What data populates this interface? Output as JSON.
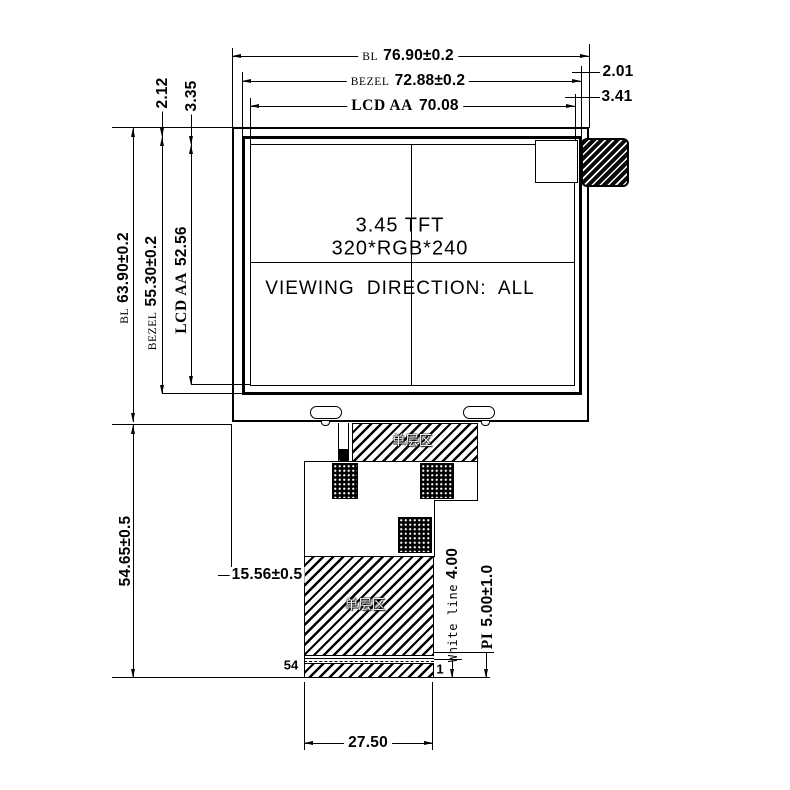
{
  "labels": {
    "top": [
      {
        "prefix": "BL",
        "value": "76.90±0.2"
      },
      {
        "prefix": "BEZEL",
        "value": "72.88±0.2"
      },
      {
        "prefix": "LCD AA",
        "value": "70.08"
      }
    ],
    "right": [
      "2.01",
      "3.41"
    ],
    "top_left": [
      "2.12",
      "3.35"
    ],
    "left": [
      {
        "prefix": "BL",
        "value": "63.90±0.2"
      },
      {
        "prefix": "BEZEL",
        "value": "55.30±0.2"
      },
      {
        "prefix": "LCD AA",
        "value": "52.56"
      }
    ],
    "total_height": "54.65±0.5",
    "fpc_offset": "15.56±0.5",
    "tail_width": "27.50",
    "pin_left": "54",
    "pin_right": "1",
    "white_line_prefix": "White line",
    "white_line_value": "4.00",
    "pi_prefix": "PI",
    "pi_value": "5.00±1.0",
    "single_layer": "单层区"
  },
  "panel": {
    "size_line": "3.45 TFT",
    "resolution_line": "320*RGB*240",
    "viewing_line": "VIEWING DIRECTION: ALL"
  },
  "colors": {
    "line": "#000000",
    "background": "#ffffff"
  }
}
